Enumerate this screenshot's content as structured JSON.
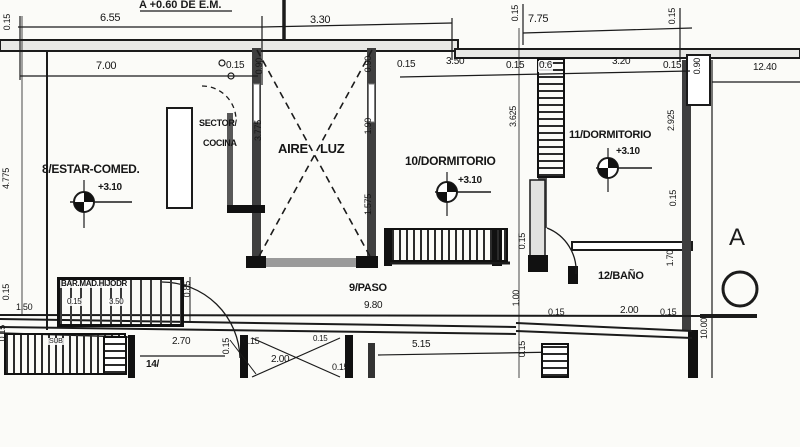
{
  "plan": {
    "title": "A +0.60 DE E.M.",
    "section_letter": "A",
    "ink_color": "#1b1b1b",
    "paper_color": "#fbfbf8",
    "rooms": [
      {
        "name": "8/ESTAR-COMED.",
        "level": "+3.10"
      },
      {
        "name": "SECTOR/COCINA"
      },
      {
        "name": "AIRE LUZ"
      },
      {
        "name": "10/DORMITORIO",
        "level": "+3.10"
      },
      {
        "name": "11/DORMITORIO",
        "level": "+3.10"
      },
      {
        "name": "12/BAÑO"
      },
      {
        "name": "9/PASO",
        "length": "9.80"
      },
      {
        "name": "14/"
      },
      {
        "name": "BAR.MAD.HIJODR"
      }
    ],
    "labels": [
      {
        "t": "6.55",
        "x": 100,
        "y": 13,
        "s": 11
      },
      {
        "t": "3.30",
        "x": 310,
        "y": 15,
        "s": 11
      },
      {
        "t": "7.75",
        "x": 528,
        "y": 14,
        "s": 11
      },
      {
        "t": "7.00",
        "x": 96,
        "y": 61,
        "s": 11
      },
      {
        "t": "0.15",
        "x": 226,
        "y": 61,
        "s": 10
      },
      {
        "t": "0.15",
        "x": 397,
        "y": 60,
        "s": 10
      },
      {
        "t": "3.50",
        "x": 446,
        "y": 57,
        "s": 10
      },
      {
        "t": "0.15",
        "x": 506,
        "y": 61,
        "s": 10
      },
      {
        "t": "0.6",
        "x": 538,
        "y": 61,
        "s": 10,
        "bg": 1
      },
      {
        "t": "3.20",
        "x": 612,
        "y": 57,
        "s": 10
      },
      {
        "t": "0.15",
        "x": 663,
        "y": 61,
        "s": 10
      },
      {
        "t": "12.40",
        "x": 753,
        "y": 63,
        "s": 10
      },
      {
        "t": "SECTOR/",
        "x": 199,
        "y": 119,
        "s": 9,
        "b": 1,
        "k": "room-label"
      },
      {
        "t": "COCINA",
        "x": 203,
        "y": 139,
        "s": 9,
        "b": 1,
        "k": "room-label"
      },
      {
        "t": "AIRE",
        "x": 278,
        "y": 142,
        "s": 13,
        "b": 1,
        "k": "room-label"
      },
      {
        "t": "LUZ",
        "x": 320,
        "y": 142,
        "s": 13,
        "b": 1,
        "k": "room-label"
      },
      {
        "t": "8/ESTAR-COMED.",
        "x": 42,
        "y": 163,
        "s": 12,
        "b": 1,
        "k": "room-label"
      },
      {
        "t": "+3.10",
        "x": 98,
        "y": 183,
        "s": 10,
        "b": 1
      },
      {
        "t": "10/DORMITORIO",
        "x": 405,
        "y": 155,
        "s": 12,
        "b": 1,
        "k": "room-label"
      },
      {
        "t": "+3.10",
        "x": 458,
        "y": 176,
        "s": 10,
        "b": 1
      },
      {
        "t": "11/DORMITORIO",
        "x": 569,
        "y": 130,
        "s": 11,
        "b": 1,
        "k": "room-label"
      },
      {
        "t": "+3.10",
        "x": 616,
        "y": 147,
        "s": 10,
        "b": 1
      },
      {
        "t": "12/BAÑO",
        "x": 598,
        "y": 271,
        "s": 11,
        "b": 1,
        "k": "room-label"
      },
      {
        "t": "9/PASO",
        "x": 349,
        "y": 283,
        "s": 11,
        "b": 1,
        "k": "room-label"
      },
      {
        "t": "9.80",
        "x": 364,
        "y": 301,
        "s": 10
      },
      {
        "t": "5.15",
        "x": 412,
        "y": 340,
        "s": 10
      },
      {
        "t": "2.70",
        "x": 172,
        "y": 337,
        "s": 10
      },
      {
        "t": "14/",
        "x": 146,
        "y": 360,
        "s": 10,
        "b": 1,
        "k": "room-label"
      },
      {
        "t": "0.15",
        "x": 243,
        "y": 337,
        "s": 9
      },
      {
        "t": "2.00",
        "x": 271,
        "y": 355,
        "s": 10
      },
      {
        "t": "0.15",
        "x": 313,
        "y": 335,
        "s": 8
      },
      {
        "t": "0.15",
        "x": 332,
        "y": 363,
        "s": 9
      },
      {
        "t": "0.15",
        "x": 548,
        "y": 308,
        "s": 9
      },
      {
        "t": "2.00",
        "x": 620,
        "y": 306,
        "s": 10
      },
      {
        "t": "0.15",
        "x": 660,
        "y": 308,
        "s": 9
      },
      {
        "t": "1.50",
        "x": 16,
        "y": 303,
        "s": 9
      },
      {
        "t": "BAR.MAD.HIJODR",
        "x": 60,
        "y": 280,
        "s": 8,
        "b": 1,
        "k": "fixture-label",
        "bg": 1
      },
      {
        "t": "0.15",
        "x": 66,
        "y": 298,
        "s": 8,
        "bg": 1
      },
      {
        "t": "3.50",
        "x": 108,
        "y": 298,
        "s": 8,
        "bg": 1
      },
      {
        "t": "SUB",
        "x": 48,
        "y": 338,
        "s": 7,
        "k": "note-label",
        "bg": 1
      },
      {
        "t": "0.15",
        "x": 3,
        "y": 14,
        "v": 1,
        "s": 9
      },
      {
        "t": "4.775",
        "x": 2,
        "y": 168,
        "v": 1,
        "s": 9
      },
      {
        "t": "0.15",
        "x": 2,
        "y": 284,
        "v": 1,
        "s": 9
      },
      {
        "t": "0.15",
        "x": -2,
        "y": 325,
        "v": 1,
        "s": 9
      },
      {
        "t": "0.90",
        "x": 255,
        "y": 58,
        "v": 1,
        "s": 9
      },
      {
        "t": "3.775",
        "x": 254,
        "y": 120,
        "v": 1,
        "s": 9
      },
      {
        "t": "0.90",
        "x": 364,
        "y": 56,
        "v": 1,
        "s": 9
      },
      {
        "t": "1.90",
        "x": 364,
        "y": 118,
        "v": 1,
        "s": 9
      },
      {
        "t": "1.575",
        "x": 364,
        "y": 194,
        "v": 1,
        "s": 9
      },
      {
        "t": "0.15",
        "x": 511,
        "y": 5,
        "v": 1,
        "s": 9
      },
      {
        "t": "3.625",
        "x": 509,
        "y": 106,
        "v": 1,
        "s": 9
      },
      {
        "t": "0.15",
        "x": 518,
        "y": 233,
        "v": 1,
        "s": 9
      },
      {
        "t": "1.00",
        "x": 512,
        "y": 290,
        "v": 1,
        "s": 9
      },
      {
        "t": "0.15",
        "x": 518,
        "y": 341,
        "v": 1,
        "s": 9
      },
      {
        "t": "0.15",
        "x": 668,
        "y": 8,
        "v": 1,
        "s": 9
      },
      {
        "t": "0.90",
        "x": 692,
        "y": 58,
        "v": 1,
        "s": 9,
        "bg": 1
      },
      {
        "t": "2.925",
        "x": 667,
        "y": 110,
        "v": 1,
        "s": 9
      },
      {
        "t": "0.15",
        "x": 669,
        "y": 190,
        "v": 1,
        "s": 9
      },
      {
        "t": "1.70",
        "x": 666,
        "y": 250,
        "v": 1,
        "s": 9
      },
      {
        "t": "10.00",
        "x": 700,
        "y": 318,
        "v": 1,
        "s": 9
      },
      {
        "t": "0.85",
        "x": 183,
        "y": 281,
        "v": 1,
        "s": 9
      },
      {
        "t": "0.15",
        "x": 222,
        "y": 338,
        "v": 1,
        "s": 9
      }
    ]
  }
}
